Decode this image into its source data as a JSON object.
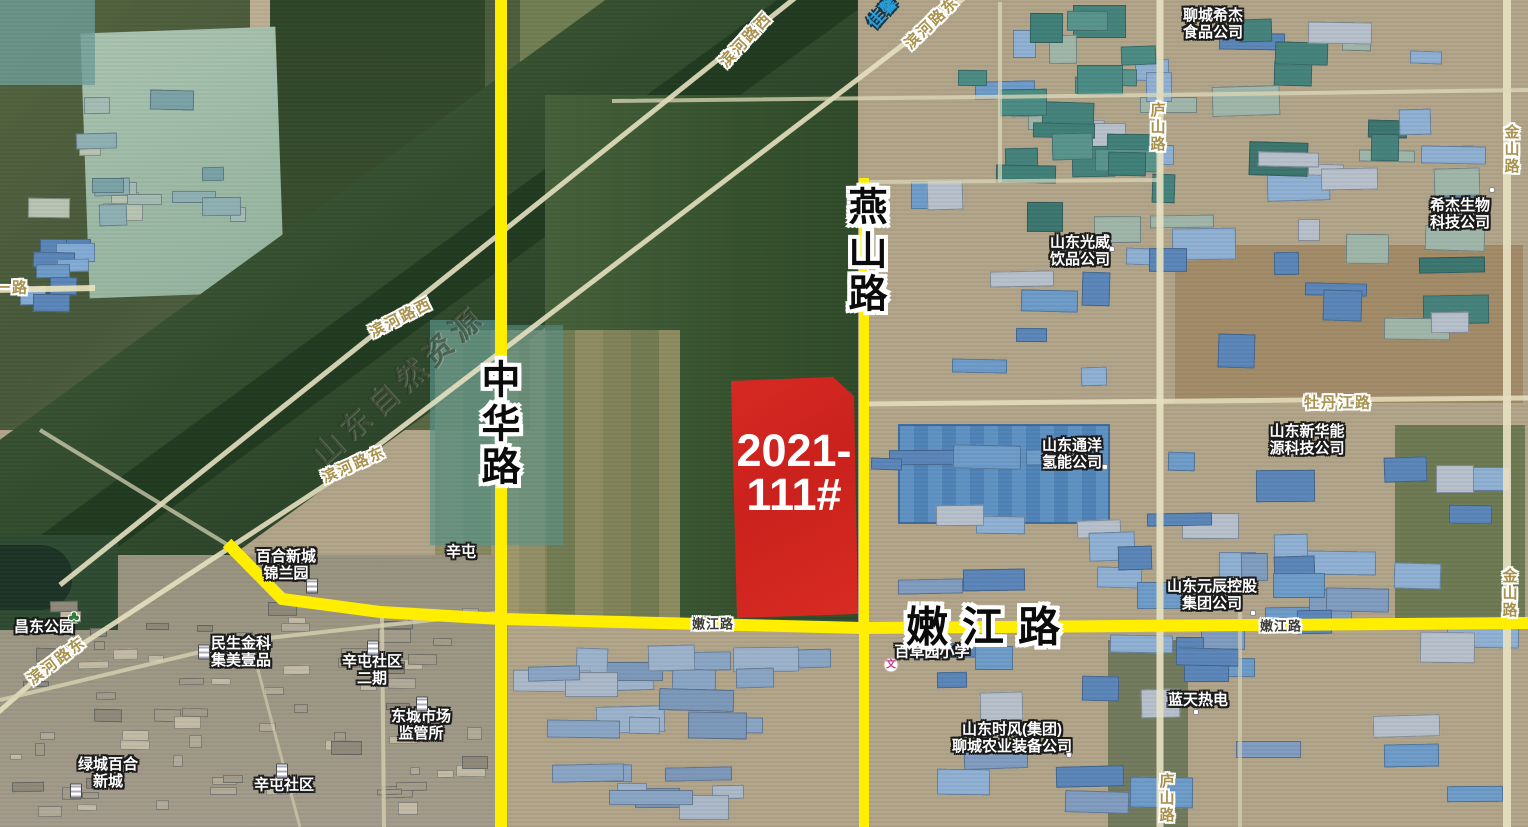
{
  "map_overlay": {
    "parcel": {
      "id_line1": "2021-",
      "id_line2": "111#",
      "full_id": "2021-111#",
      "fill_color": "#dc231f"
    },
    "highlight_road_color": "#ffee00",
    "major_road_labels": {
      "zhonghua": "中华路",
      "yanshan": "燕山路",
      "nenjiang": "嫩江路"
    }
  },
  "base_map": {
    "watermark": "山东自然资源",
    "road_labels": {
      "binhe_west": "滨河路西",
      "binhe_east": "滨河路东",
      "lushan": "庐山路",
      "jinshan": "金山路",
      "mudanjiang": "牡丹江路",
      "yilu": "一路",
      "nenjiang_small": "嫩江路",
      "jiaxin": "佳馨"
    },
    "poi_labels": {
      "liaocheng_cj_food": {
        "line1": "聊城希杰",
        "line2": "食品公司"
      },
      "cj_bio": {
        "line1": "希杰生物",
        "line2": "科技公司"
      },
      "guangwei": {
        "line1": "山东光威",
        "line2": "饮品公司"
      },
      "tongyang": {
        "line1": "山东通洋",
        "line2": "氢能公司"
      },
      "xinhua_energy": {
        "line1": "山东新华能",
        "line2": "源科技公司"
      },
      "yuanchen": {
        "line1": "山东元辰控股",
        "line2": "集团公司"
      },
      "lantian": {
        "line1": "蓝天热电"
      },
      "shifeng": {
        "line1": "山东时风(集团)",
        "line2": "聊城农业装备公司"
      },
      "baicaoyuan_school": {
        "line1": "百草园小学"
      },
      "minsheng": {
        "line1": "民生金科",
        "line2": "集美壹品"
      },
      "baihe_jinlan": {
        "line1": "百合新城",
        "line2": "锦兰园"
      },
      "changdong_park": {
        "line1": "昌东公园"
      },
      "lvcheng_baihe": {
        "line1": "绿城百合",
        "line2": "新城"
      },
      "xintun_shequ": {
        "line1": "辛屯社区"
      },
      "xintun_erqi": {
        "line1": "辛屯社区",
        "line2": "二期"
      },
      "dongcheng_market": {
        "line1": "东城市场",
        "line2": "监管所"
      },
      "xintun": {
        "line1": "辛屯"
      }
    }
  }
}
